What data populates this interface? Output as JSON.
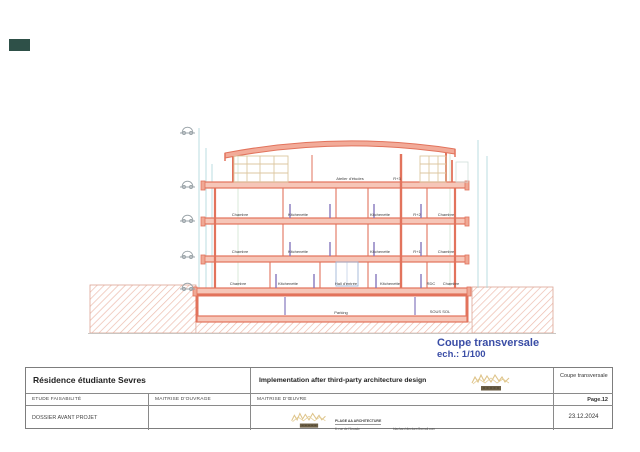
{
  "colors": {
    "accent_salmon": "#e2735c",
    "caption_blue": "#3a4da6",
    "logo_gold": "#d8b873",
    "logo_bar": "#6b5e44",
    "corner_mark_teal": "#2e5048"
  },
  "drawing": {
    "caption": {
      "title": "Coupe transversale",
      "scale": "ech.: 1/100"
    },
    "attic": {
      "room": "Atelier d'études",
      "level": "R+3"
    },
    "floor2": {
      "room1": "Chambre",
      "room2": "Kitchenette",
      "room3": "Kitchenette",
      "level": "R+2",
      "room4": "Chambre"
    },
    "floor1": {
      "room1": "Chambre",
      "room2": "Kitchenette",
      "room3": "Kitchenette",
      "level": "R+1",
      "room4": "Chambre"
    },
    "ground_floor": {
      "room1": "Chambre",
      "room2": "Kitchenette",
      "hall": "Hall d'entrée",
      "room3": "Kitchenette",
      "level": "RDC",
      "room4": "Chambre"
    },
    "basement": {
      "room": "Parking",
      "level": "SOUS SOL"
    }
  },
  "title_block": {
    "project": "Résidence étudiante Sevres",
    "note": "Implementation after third-party architecture design",
    "drawing_name": "Coupe transversale",
    "row2": {
      "col1": "ETUDE FAISABILITÉ",
      "col2": "MAITRISE D'OUVRAGE",
      "col3": "MAITRISE D'ŒUVRE",
      "page": "Page.12"
    },
    "row3": {
      "phase": "DOSSIER AVANT PROJET",
      "date": "23.12.2024"
    },
    "architect": {
      "name": "PLAGE AA ARCHITECTURE",
      "address_line1": "6, rue de l'Arcade",
      "address_line2": "75008 Paris",
      "email": "blacharchitecture@gmail.com",
      "website": "www.studioblacharchitecture.com",
      "phone": "06 07 98 83 29 92"
    }
  }
}
